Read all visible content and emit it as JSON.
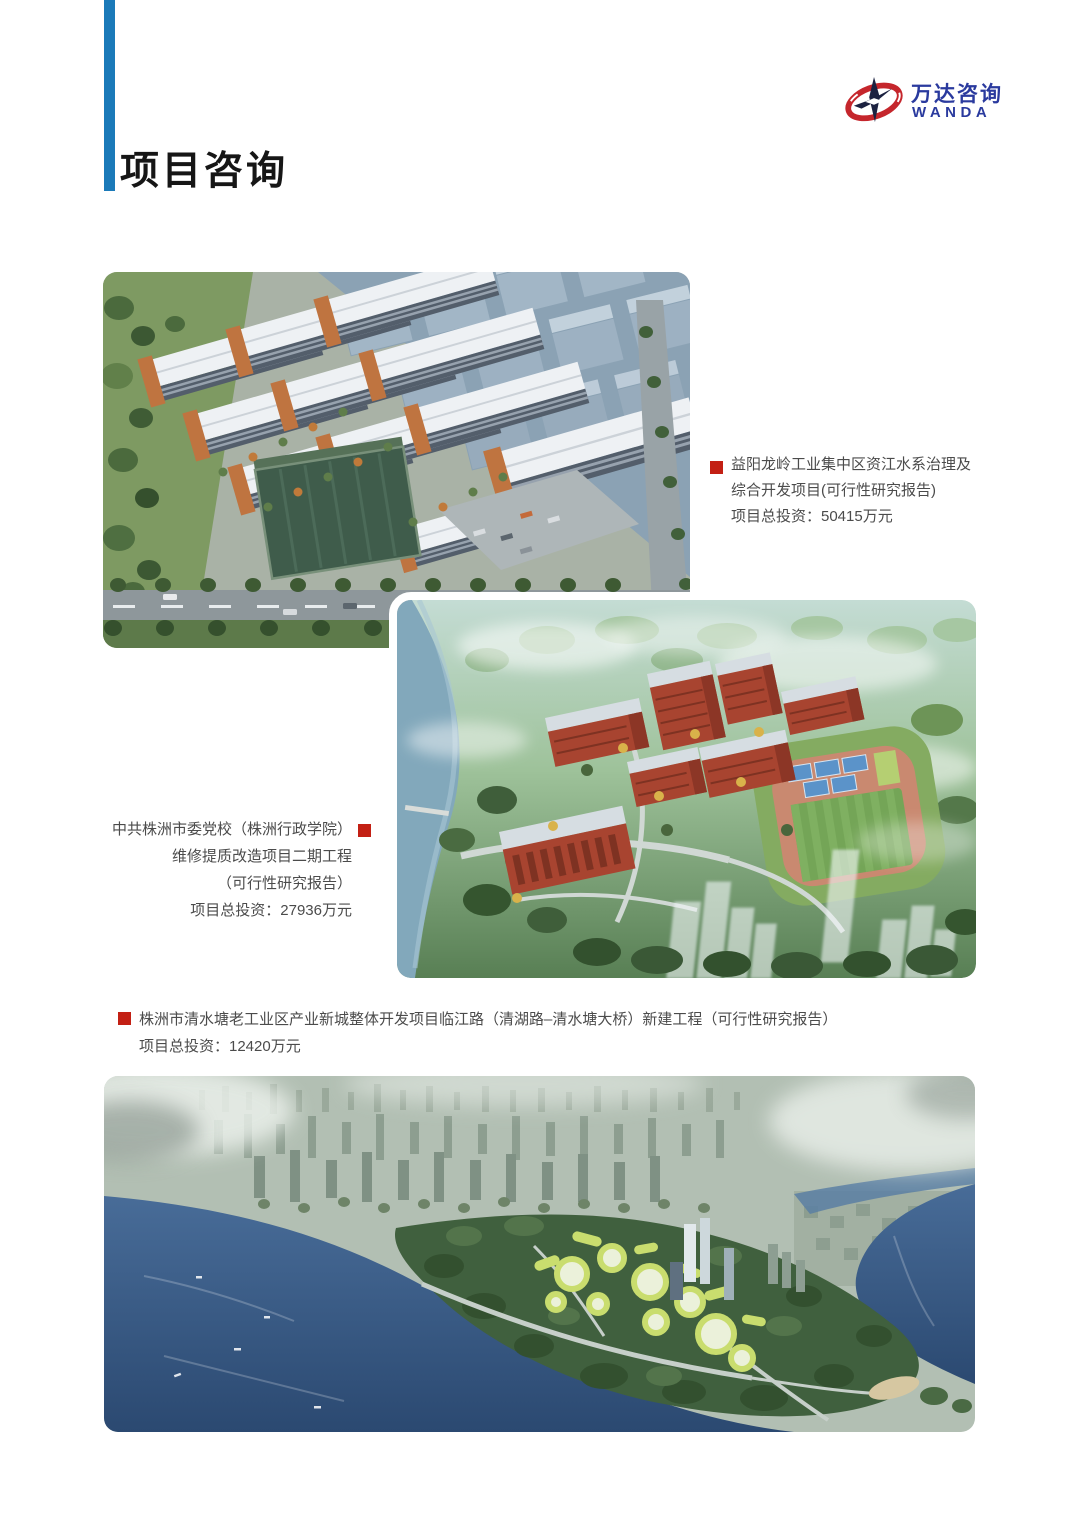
{
  "page": {
    "title": "项目咨询"
  },
  "brand": {
    "name_cn": "万达咨询",
    "name_en": "WANDA"
  },
  "colors": {
    "accent_bar": "#1b7ab9",
    "bullet_red": "#c32014",
    "logo_blue": "#2a3a9e",
    "logo_red": "#c5262c",
    "body_text": "#4b4b4b"
  },
  "projects": [
    {
      "title_lines": [
        "益阳龙岭工业集中区资江水系治理及",
        "综合开发项目(可行性研究报告)"
      ],
      "investment": "项目总投资：50415万元"
    },
    {
      "title_lines": [
        "中共株洲市委党校（株洲行政学院）",
        "维修提质改造项目二期工程",
        "（可行性研究报告）"
      ],
      "investment": "项目总投资：27936万元"
    },
    {
      "title_lines": [
        "株洲市清水塘老工业区产业新城整体开发项目临江路（清湖路–清水塘大桥）新建工程（可行性研究报告）"
      ],
      "investment": "项目总投资：12420万元"
    }
  ]
}
